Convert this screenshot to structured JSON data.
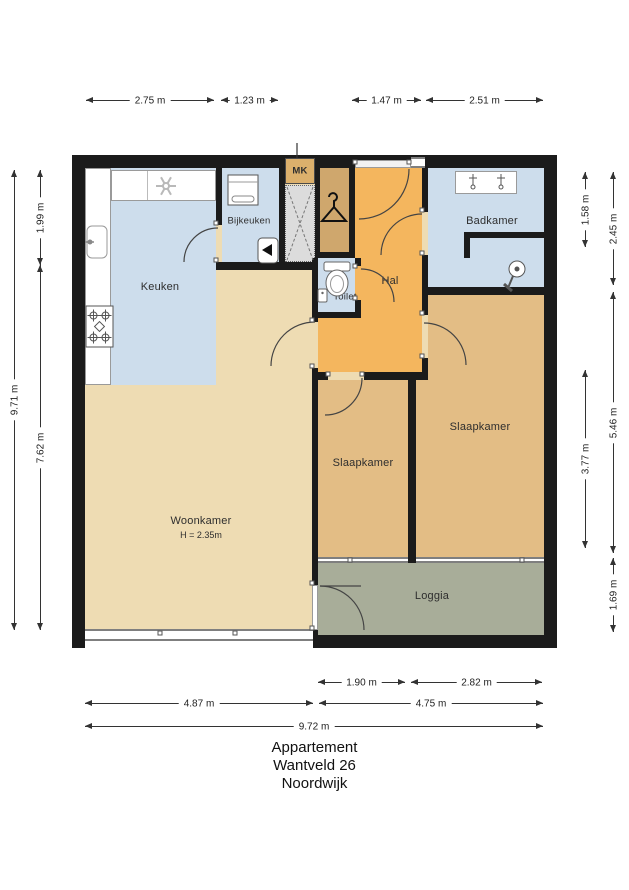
{
  "title": {
    "lines": [
      "Appartement",
      "Wantveld 26",
      "Noordwijk"
    ]
  },
  "rooms": {
    "keuken": {
      "label": "Keuken"
    },
    "bijkeuken": {
      "label": "Bijkeuken"
    },
    "mk": {
      "label": "MK"
    },
    "hal": {
      "label": "Hal"
    },
    "toilet": {
      "label": "Toilet"
    },
    "badkamer": {
      "label": "Badkamer"
    },
    "slaapkamer_left": {
      "label": "Slaapkamer"
    },
    "slaapkamer_right": {
      "label": "Slaapkamer"
    },
    "woonkamer": {
      "label": "Woonkamer",
      "height_note": "H = 2.35m"
    },
    "loggia": {
      "label": "Loggia"
    }
  },
  "dimensions": {
    "top": [
      "2.75 m",
      "1.23 m",
      "1.47 m",
      "2.51 m"
    ],
    "left": [
      "9.71 m",
      "1.99 m",
      "7.62 m"
    ],
    "right": [
      "1.58 m",
      "3.77 m",
      "2.45 m",
      "5.46 m",
      "1.69 m"
    ],
    "bottom": [
      "1.90 m",
      "2.82 m",
      "4.87 m",
      "4.75 m",
      "9.72 m"
    ]
  },
  "colors": {
    "wall": "#1b1b1b",
    "wet_room": "#cdddec",
    "hal": "#f4b65e",
    "closet": "#cfa76d",
    "mk": "#dcb06c",
    "slaapkamer": "#e3bd85",
    "woonkamer": "#eedcb3",
    "loggia": "#a8ad99",
    "shaft": "#dcdcdc"
  },
  "icons": {
    "extractor_fan": "fan-asterisk",
    "kitchen_sink": "sink-basin",
    "stove": "four-burner-hob",
    "washing_machine": "washer-square",
    "boiler": "boiler-arrow",
    "wardrobe": "coat-hanger",
    "toilet_bowl": "toilet",
    "hand_basin": "small-basin",
    "vanity_taps": "double-washbasin-taps",
    "shower": "shower-head"
  }
}
